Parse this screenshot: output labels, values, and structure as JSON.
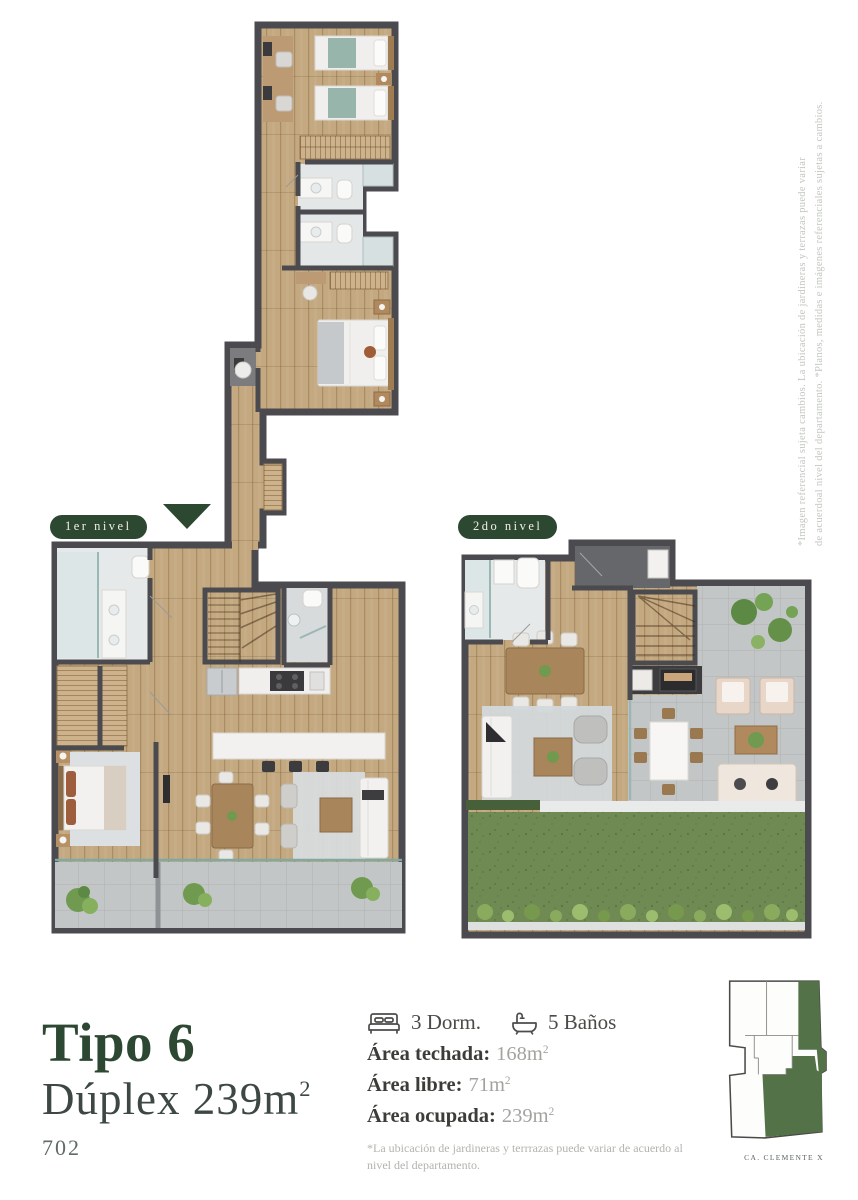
{
  "page": {
    "width": 858,
    "height": 1200,
    "background": "#ffffff"
  },
  "colors": {
    "accent_green": "#2c4831",
    "title_green": "#2d4832",
    "keyplan_green": "#547247",
    "grass_green": "#6f8a53",
    "wood_floor": "#c3a880",
    "wall": "#4b4b4f",
    "terrace_tile": "#c3c6c6"
  },
  "levels": [
    {
      "id": "level1",
      "label": "1er nivel"
    },
    {
      "id": "level2",
      "label": "2do nivel"
    }
  ],
  "icons": {
    "bedrooms": "bed-icon",
    "bathrooms": "bath-icon",
    "entrance": "arrow-down-icon"
  },
  "title_block": {
    "type_name": "Tipo 6",
    "subtitle_text": "Dúplex 239m",
    "subtitle_sup": "2",
    "unit_number": "702"
  },
  "specs": {
    "bedrooms_label": "3 Dorm.",
    "bathrooms_label": "5 Baños",
    "areas": [
      {
        "label": "Área techada:",
        "value": "168m",
        "sup": "2"
      },
      {
        "label": "Área libre:",
        "value": "71m",
        "sup": "2"
      },
      {
        "label": "Área ocupada:",
        "value": "239m",
        "sup": "2"
      }
    ],
    "footnote": "*La ubicación de jardineras y terrrazas puede variar de acuerdo al nivel del departamento."
  },
  "side_note": {
    "line1": "*Imagen referencial sujeta cambios. La ubicación de jardineras y terrazas puede variar",
    "line2": "de acuerdoal nivel del departamento. *Planos, medidas e imágenes referenciales sujetas a cambios."
  },
  "keyplan": {
    "caption": "CA. CLEMENTE X"
  }
}
